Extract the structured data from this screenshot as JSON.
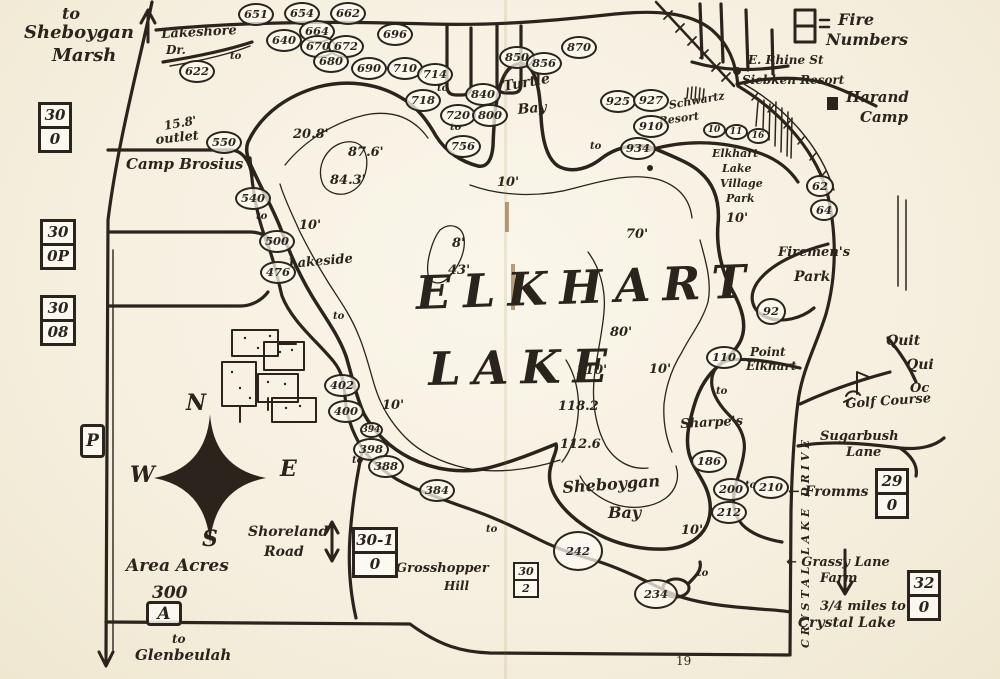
{
  "map": {
    "title": "ELKHART LAKE",
    "page_number": "19",
    "colors": {
      "ink": "#2a241c",
      "paper": "#f6f1e3"
    },
    "legend": {
      "line1": "Fire",
      "line2": "Numbers"
    },
    "compass": {
      "n": "N",
      "e": "E",
      "s": "S",
      "w": "W"
    },
    "to_text": "to",
    "labels": [
      {
        "t": "to",
        "x": 62,
        "y": 6,
        "fs": 16,
        "name": "to-sheboygan-marsh"
      },
      {
        "t": "Sheboygan",
        "x": 24,
        "y": 24,
        "fs": 18,
        "name": "sheboygan-marsh-label"
      },
      {
        "t": "Marsh",
        "x": 52,
        "y": 47,
        "fs": 18,
        "name": "sheboygan-marsh-label-2"
      },
      {
        "t": "Lakeshore",
        "x": 161,
        "y": 28,
        "fs": 13,
        "rot": -3,
        "name": "lakeshore-dr-label"
      },
      {
        "t": "Dr.",
        "x": 166,
        "y": 44,
        "fs": 12,
        "name": "lakeshore-dr-label-2"
      },
      {
        "t": "15.8'",
        "x": 163,
        "y": 120,
        "fs": 12,
        "rot": -10,
        "name": "outlet-depth-label"
      },
      {
        "t": "outlet",
        "x": 155,
        "y": 134,
        "fs": 13,
        "rot": -6,
        "name": "outlet-label"
      },
      {
        "t": "Camp Brosius",
        "x": 126,
        "y": 157,
        "fs": 15,
        "name": "camp-brosius-label"
      },
      {
        "t": "Turtle",
        "x": 502,
        "y": 80,
        "fs": 14,
        "rot": -10,
        "name": "turtle-bay-label"
      },
      {
        "t": "Bay",
        "x": 517,
        "y": 103,
        "fs": 14,
        "rot": -5,
        "name": "turtle-bay-label-2"
      },
      {
        "t": "E. Rhine St",
        "x": 748,
        "y": 54,
        "fs": 12,
        "name": "e-rhine-st-label"
      },
      {
        "t": "Siebken Resort",
        "x": 742,
        "y": 74,
        "fs": 12,
        "name": "siebken-resort-label"
      },
      {
        "t": "Harand",
        "x": 846,
        "y": 90,
        "fs": 15,
        "name": "harand-camp-label"
      },
      {
        "t": "Camp",
        "x": 860,
        "y": 110,
        "fs": 15,
        "name": "harand-camp-label-2"
      },
      {
        "t": "Schwartz",
        "x": 668,
        "y": 100,
        "fs": 11,
        "rot": -10,
        "name": "schwartz-resort-label"
      },
      {
        "t": "Resort",
        "x": 658,
        "y": 116,
        "fs": 11,
        "rot": -8,
        "name": "schwartz-resort-label-2"
      },
      {
        "t": "Elkhart",
        "x": 712,
        "y": 148,
        "fs": 11,
        "name": "village-park-label"
      },
      {
        "t": "Lake",
        "x": 722,
        "y": 163,
        "fs": 11,
        "name": "village-park-label-2"
      },
      {
        "t": "Village",
        "x": 720,
        "y": 178,
        "fs": 11,
        "name": "village-park-label-3"
      },
      {
        "t": "Park",
        "x": 726,
        "y": 193,
        "fs": 11,
        "name": "village-park-label-4"
      },
      {
        "t": "Firemen's",
        "x": 778,
        "y": 246,
        "fs": 13,
        "name": "firemens-park-label"
      },
      {
        "t": "Park",
        "x": 794,
        "y": 270,
        "fs": 14,
        "name": "firemens-park-label-2"
      },
      {
        "t": "Point",
        "x": 750,
        "y": 346,
        "fs": 12,
        "name": "point-elkhart-label"
      },
      {
        "t": "Elkhart",
        "x": 746,
        "y": 360,
        "fs": 12,
        "name": "point-elkhart-label-2"
      },
      {
        "t": "Quit",
        "x": 886,
        "y": 334,
        "fs": 14,
        "name": "quit-qui-oc-label"
      },
      {
        "t": "Qui",
        "x": 906,
        "y": 358,
        "fs": 14,
        "name": "quit-qui-oc-label-2"
      },
      {
        "t": "Oc",
        "x": 910,
        "y": 382,
        "fs": 13,
        "name": "quit-qui-oc-label-3"
      },
      {
        "t": "Golf Course",
        "x": 845,
        "y": 398,
        "fs": 13,
        "rot": -4,
        "name": "golf-course-label"
      },
      {
        "t": "Sharpe's",
        "x": 680,
        "y": 418,
        "fs": 13,
        "rot": -3,
        "name": "sharpes-label"
      },
      {
        "t": "Sugarbush",
        "x": 820,
        "y": 430,
        "fs": 13,
        "name": "sugarbush-lane-label"
      },
      {
        "t": "Lane",
        "x": 846,
        "y": 446,
        "fs": 13,
        "name": "sugarbush-lane-label-2"
      },
      {
        "t": "← Fromms",
        "x": 788,
        "y": 485,
        "fs": 14,
        "name": "fromms-label"
      },
      {
        "t": "← Grassy Lane",
        "x": 786,
        "y": 556,
        "fs": 13,
        "name": "grassy-lane-farm-label"
      },
      {
        "t": "Farm",
        "x": 820,
        "y": 572,
        "fs": 13,
        "name": "grassy-lane-farm-label-2"
      },
      {
        "t": "3/4 miles to",
        "x": 820,
        "y": 600,
        "fs": 13,
        "name": "crystal-lake-distance-label"
      },
      {
        "t": "Crystal Lake",
        "x": 798,
        "y": 616,
        "fs": 14,
        "name": "crystal-lake-label"
      },
      {
        "t": "Sheboygan",
        "x": 562,
        "y": 480,
        "fs": 16,
        "rot": -4,
        "name": "sheboygan-bay-label"
      },
      {
        "t": "Bay",
        "x": 608,
        "y": 505,
        "fs": 16,
        "name": "sheboygan-bay-label-2"
      },
      {
        "t": "Grosshopper",
        "x": 396,
        "y": 562,
        "fs": 13,
        "name": "grasshopper-hill-label"
      },
      {
        "t": "Hill",
        "x": 444,
        "y": 580,
        "fs": 12,
        "name": "grasshopper-hill-label-2"
      },
      {
        "t": "Area Acres",
        "x": 126,
        "y": 558,
        "fs": 17,
        "name": "area-acres-label"
      },
      {
        "t": "300",
        "x": 152,
        "y": 585,
        "fs": 17,
        "name": "area-acres-label-2"
      },
      {
        "t": "Shoreland",
        "x": 248,
        "y": 525,
        "fs": 14,
        "name": "shoreland-road-label"
      },
      {
        "t": "Road",
        "x": 264,
        "y": 545,
        "fs": 14,
        "name": "shoreland-road-label-2"
      },
      {
        "t": "to",
        "x": 172,
        "y": 633,
        "fs": 12,
        "name": "to-glenbeulah-label"
      },
      {
        "t": "Glenbeulah",
        "x": 135,
        "y": 648,
        "fs": 15,
        "name": "glenbeulah-label"
      },
      {
        "t": "Lakeside",
        "x": 288,
        "y": 258,
        "fs": 13,
        "rot": -5,
        "name": "lakeside-label"
      },
      {
        "t": "ELKHART",
        "x": 415,
        "y": 270,
        "fs": 46,
        "cls": "title",
        "rot": -2,
        "name": "lake-title"
      },
      {
        "t": "LAKE",
        "x": 428,
        "y": 346,
        "fs": 46,
        "cls": "title",
        "rot": -1,
        "name": "lake-title-2"
      },
      {
        "t": "CRYSTAL LAKE DRIVE",
        "x": 800,
        "y": 648,
        "fs": 11,
        "rot": -90,
        "cls": "vert",
        "name": "crystal-lake-drive-label"
      }
    ],
    "depth_labels": [
      {
        "t": "20.8'",
        "x": 293,
        "y": 128
      },
      {
        "t": "87.6'",
        "x": 348,
        "y": 146
      },
      {
        "t": "84.3'",
        "x": 330,
        "y": 174
      },
      {
        "t": "8'",
        "x": 452,
        "y": 237
      },
      {
        "t": "43'",
        "x": 448,
        "y": 264
      },
      {
        "t": "70'",
        "x": 626,
        "y": 228
      },
      {
        "t": "80'",
        "x": 610,
        "y": 326
      },
      {
        "t": "110'",
        "x": 576,
        "y": 364
      },
      {
        "t": "118.2",
        "x": 558,
        "y": 400
      },
      {
        "t": "112.6",
        "x": 560,
        "y": 438
      },
      {
        "t": "10'",
        "x": 497,
        "y": 176
      },
      {
        "t": "10'",
        "x": 299,
        "y": 219
      },
      {
        "t": "10'",
        "x": 382,
        "y": 399
      },
      {
        "t": "10'",
        "x": 649,
        "y": 363
      },
      {
        "t": "10'",
        "x": 726,
        "y": 212
      },
      {
        "t": "10'",
        "x": 681,
        "y": 524
      }
    ],
    "to_markers": [
      {
        "x": 230,
        "y": 52
      },
      {
        "x": 437,
        "y": 84
      },
      {
        "x": 450,
        "y": 123
      },
      {
        "x": 590,
        "y": 142
      },
      {
        "x": 256,
        "y": 212
      },
      {
        "x": 333,
        "y": 312
      },
      {
        "x": 352,
        "y": 456
      },
      {
        "x": 486,
        "y": 525
      },
      {
        "x": 716,
        "y": 387
      },
      {
        "x": 745,
        "y": 481
      },
      {
        "x": 697,
        "y": 569
      }
    ],
    "fire_number_circles": [
      {
        "n": "651",
        "x": 256,
        "y": 14
      },
      {
        "n": "654",
        "x": 302,
        "y": 13
      },
      {
        "n": "662",
        "x": 348,
        "y": 13
      },
      {
        "n": "622",
        "x": 197,
        "y": 71
      },
      {
        "n": "640",
        "x": 284,
        "y": 40
      },
      {
        "n": "664",
        "x": 317,
        "y": 31
      },
      {
        "n": "670",
        "x": 318,
        "y": 46
      },
      {
        "n": "672",
        "x": 346,
        "y": 46
      },
      {
        "n": "680",
        "x": 331,
        "y": 61
      },
      {
        "n": "690",
        "x": 369,
        "y": 68
      },
      {
        "n": "696",
        "x": 395,
        "y": 34
      },
      {
        "n": "710",
        "x": 405,
        "y": 68
      },
      {
        "n": "714",
        "x": 435,
        "y": 74
      },
      {
        "n": "718",
        "x": 423,
        "y": 100
      },
      {
        "n": "720",
        "x": 458,
        "y": 115
      },
      {
        "n": "840",
        "x": 483,
        "y": 94
      },
      {
        "n": "800",
        "x": 490,
        "y": 115
      },
      {
        "n": "756",
        "x": 463,
        "y": 146
      },
      {
        "n": "850",
        "x": 517,
        "y": 57
      },
      {
        "n": "856",
        "x": 544,
        "y": 63
      },
      {
        "n": "870",
        "x": 579,
        "y": 47
      },
      {
        "n": "925",
        "x": 618,
        "y": 101
      },
      {
        "n": "927",
        "x": 651,
        "y": 100
      },
      {
        "n": "910",
        "x": 651,
        "y": 126
      },
      {
        "n": "934",
        "x": 638,
        "y": 148
      },
      {
        "n": "550",
        "x": 224,
        "y": 142
      },
      {
        "n": "540",
        "x": 253,
        "y": 198
      },
      {
        "n": "500",
        "x": 277,
        "y": 241
      },
      {
        "n": "476",
        "x": 278,
        "y": 272
      },
      {
        "n": "62",
        "x": 820,
        "y": 186,
        "w": 28,
        "h": 22
      },
      {
        "n": "64",
        "x": 824,
        "y": 210,
        "w": 28,
        "h": 22
      },
      {
        "n": "92",
        "x": 771,
        "y": 311,
        "w": 30,
        "h": 27
      },
      {
        "n": "110",
        "x": 724,
        "y": 357
      },
      {
        "n": "186",
        "x": 709,
        "y": 461
      },
      {
        "n": "200",
        "x": 731,
        "y": 489
      },
      {
        "n": "210",
        "x": 771,
        "y": 487
      },
      {
        "n": "212",
        "x": 729,
        "y": 512
      },
      {
        "n": "242",
        "x": 578,
        "y": 551,
        "w": 50,
        "h": 40
      },
      {
        "n": "234",
        "x": 656,
        "y": 594,
        "w": 44,
        "h": 30
      },
      {
        "n": "402",
        "x": 342,
        "y": 385
      },
      {
        "n": "400",
        "x": 346,
        "y": 411
      },
      {
        "n": "394",
        "x": 371,
        "y": 430,
        "small": true
      },
      {
        "n": "398",
        "x": 371,
        "y": 449
      },
      {
        "n": "388",
        "x": 386,
        "y": 466
      },
      {
        "n": "384",
        "x": 437,
        "y": 490
      },
      {
        "n": "10",
        "x": 714,
        "y": 130,
        "small": true
      },
      {
        "n": "11",
        "x": 736,
        "y": 132,
        "small": true
      },
      {
        "n": "16",
        "x": 758,
        "y": 136,
        "small": true
      }
    ],
    "road_signs": [
      {
        "top": "30",
        "bottom": "0",
        "x": 38,
        "y": 102,
        "w": 34
      },
      {
        "top": "30",
        "bottom": "0P",
        "x": 40,
        "y": 219,
        "w": 36
      },
      {
        "top": "30",
        "bottom": "08",
        "x": 40,
        "y": 295,
        "w": 36
      },
      {
        "top": "30-1",
        "bottom": "0",
        "x": 352,
        "y": 527,
        "w": 46
      },
      {
        "top": "30",
        "bottom": "2",
        "x": 513,
        "y": 562,
        "w": 26,
        "small": true
      },
      {
        "top": "29",
        "bottom": "0",
        "x": 875,
        "y": 468,
        "w": 34
      },
      {
        "top": "32",
        "bottom": "0",
        "x": 907,
        "y": 570,
        "w": 34
      }
    ],
    "highway_markers": [
      {
        "label": "P",
        "x": 80,
        "y": 424,
        "w": 25,
        "h": 34
      },
      {
        "label": "A",
        "x": 146,
        "y": 601,
        "w": 36,
        "h": 25
      }
    ]
  }
}
